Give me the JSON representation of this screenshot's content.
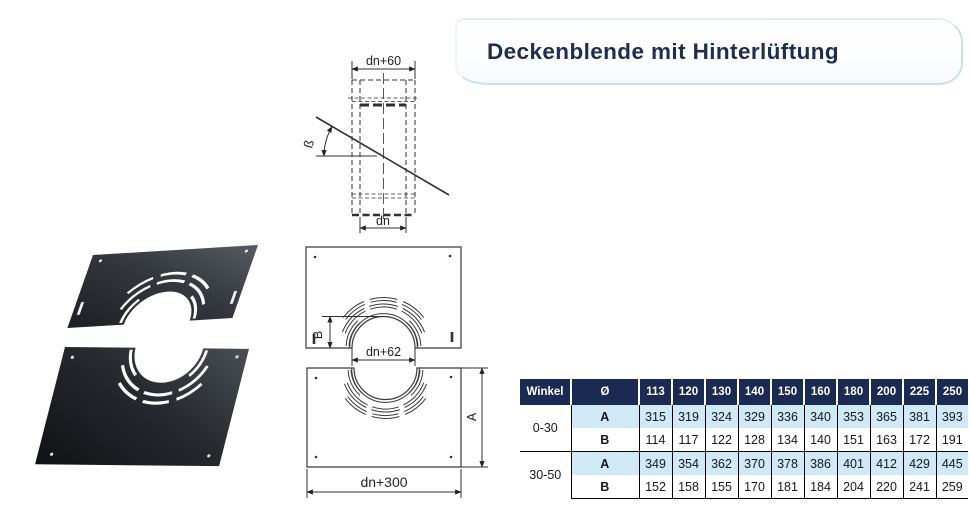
{
  "banner": {
    "title": "Deckenblende mit Hinterlüftung",
    "title_color": "#1d2c4f",
    "border_color": "#cbe0ea"
  },
  "diagram": {
    "dim_outer": "dn+60",
    "dim_inner": "dn",
    "angle_label": "ß",
    "dim_b": "B",
    "dim_opening": "dn+62",
    "dim_a": "A",
    "dim_plate_width": "dn+300"
  },
  "table": {
    "colors": {
      "header_bg": "#1b2a52",
      "row_a_bg": "#cfe9f7"
    },
    "header": {
      "winkel": "Winkel",
      "diameter": "Ø",
      "sizes": [
        "113",
        "120",
        "130",
        "140",
        "150",
        "160",
        "180",
        "200",
        "225",
        "250"
      ]
    },
    "groups": [
      {
        "winkel": "0-30",
        "rows": [
          {
            "label": "A",
            "values": [
              "315",
              "319",
              "324",
              "329",
              "336",
              "340",
              "353",
              "365",
              "381",
              "393"
            ]
          },
          {
            "label": "B",
            "values": [
              "114",
              "117",
              "122",
              "128",
              "134",
              "140",
              "151",
              "163",
              "172",
              "191"
            ]
          }
        ]
      },
      {
        "winkel": "30-50",
        "rows": [
          {
            "label": "A",
            "values": [
              "349",
              "354",
              "362",
              "370",
              "378",
              "386",
              "401",
              "412",
              "429",
              "445"
            ]
          },
          {
            "label": "B",
            "values": [
              "152",
              "158",
              "155",
              "170",
              "181",
              "184",
              "204",
              "220",
              "241",
              "259"
            ]
          }
        ]
      }
    ]
  }
}
